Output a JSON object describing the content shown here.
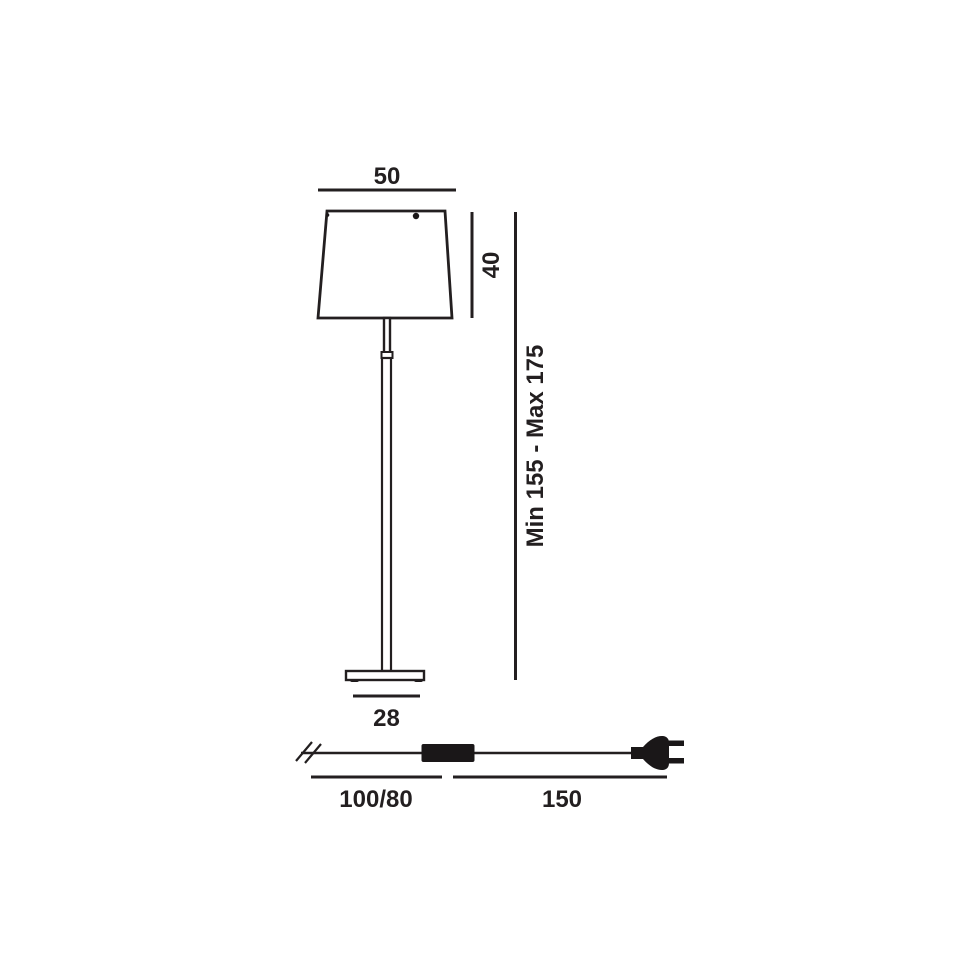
{
  "diagram": {
    "line_color": "#231f20",
    "background_color": "#ffffff",
    "labels": {
      "shade_width": "50",
      "shade_height": "40",
      "total_height_range": "Min 155 - Max 175",
      "base_width": "28",
      "cable_length_wire": "100/80",
      "cable_length_plug_end": "150"
    }
  }
}
